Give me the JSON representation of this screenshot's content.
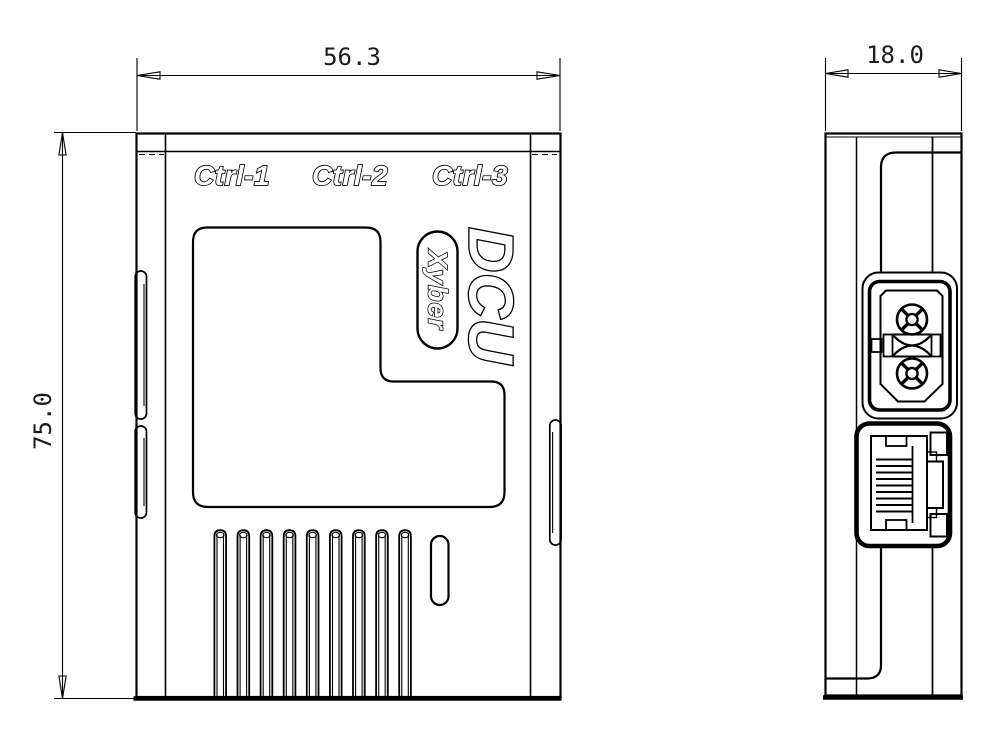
{
  "drawing": {
    "colors": {
      "line": "#000000",
      "background": "#ffffff",
      "text_fill": "#ffffff"
    },
    "front_view": {
      "port_labels": [
        "Ctrl-1",
        "Ctrl-2",
        "Ctrl-3"
      ],
      "product_name": "DCU",
      "brand": "Xyber",
      "width_dimension": "56.3",
      "height_dimension": "75.0"
    },
    "side_view": {
      "depth_dimension": "18.0"
    }
  }
}
